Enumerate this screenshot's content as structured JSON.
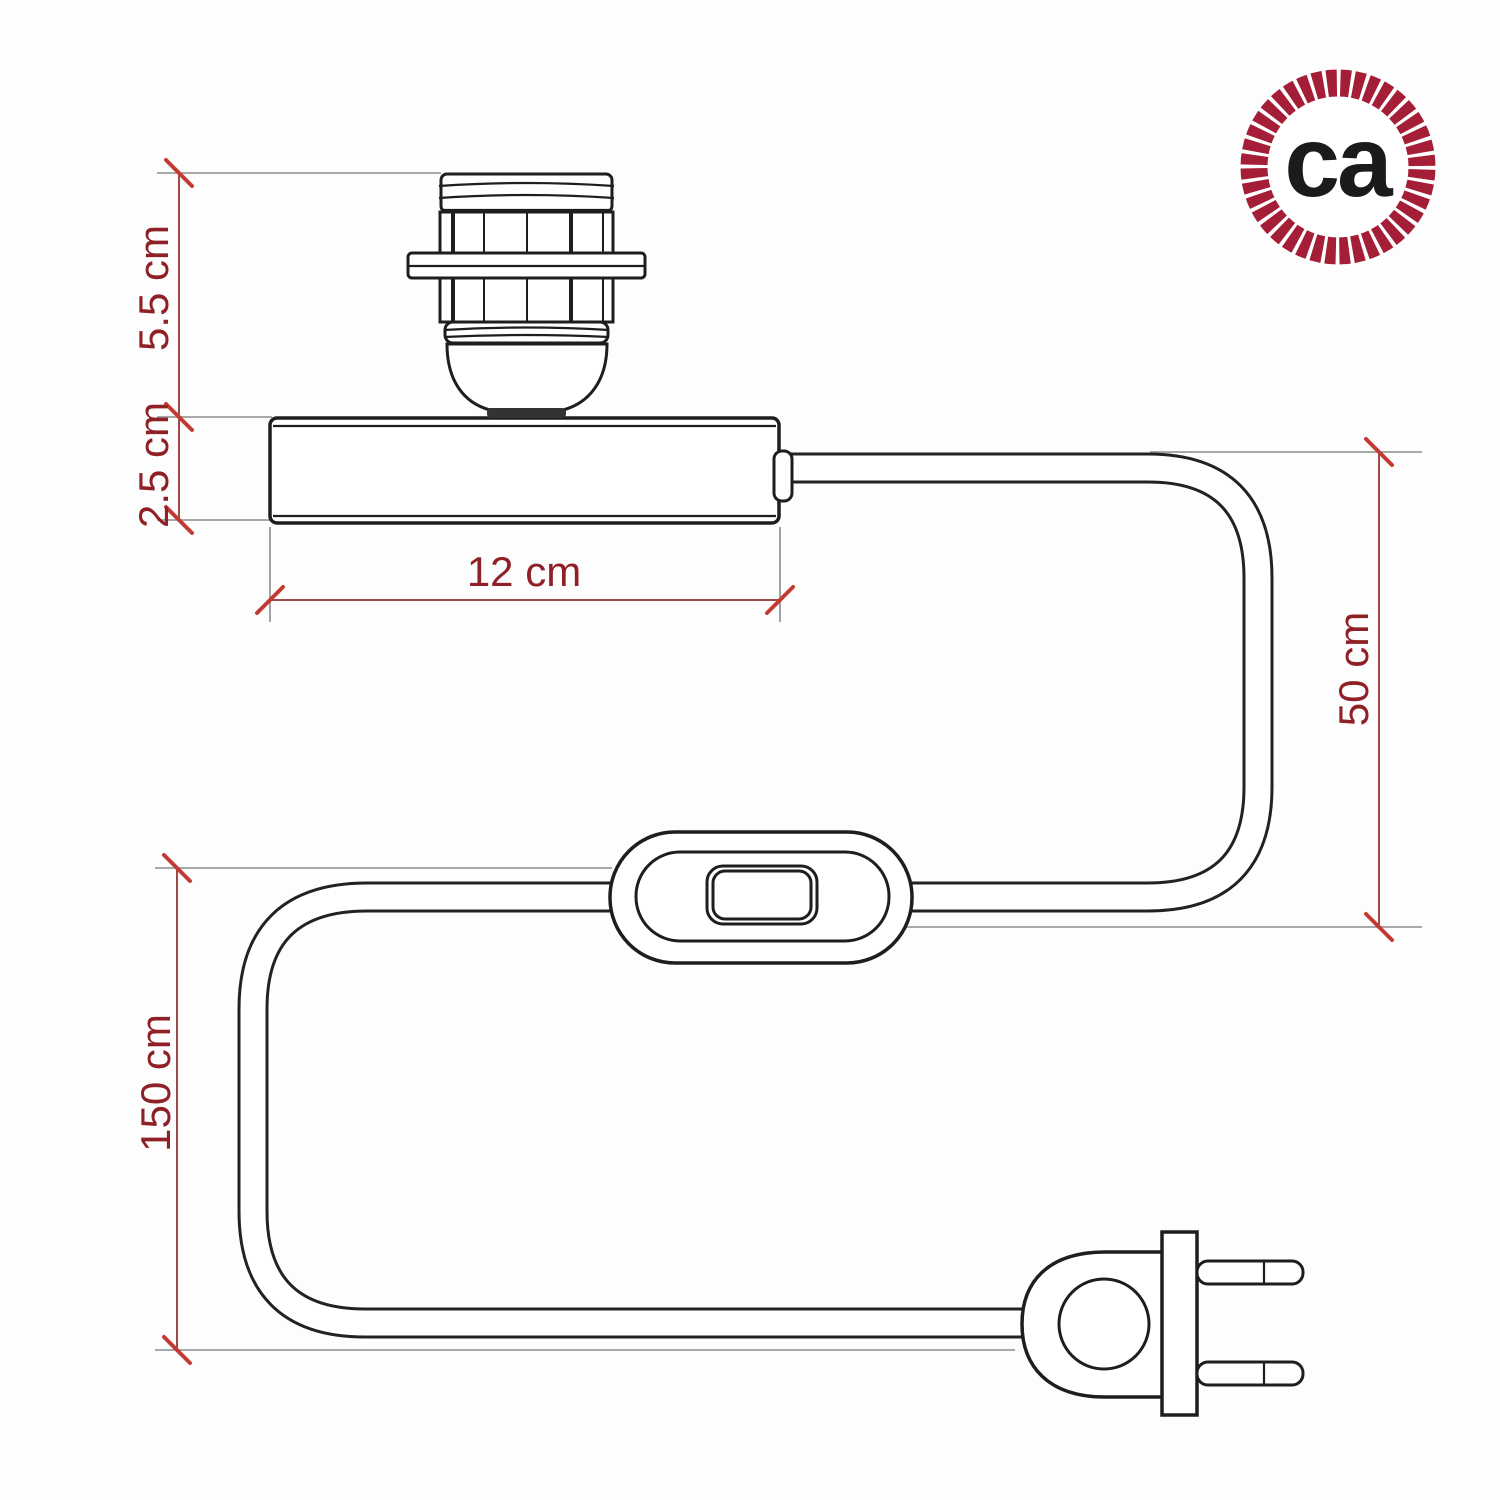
{
  "title": "Table lamp base technical drawing with dimensions",
  "logo": {
    "text": "ca"
  },
  "dimensions": {
    "socket_height": "5.5 cm",
    "base_height": "2.5 cm",
    "base_width": "12 cm",
    "base_to_switch_cable": "50 cm",
    "switch_to_plug_cable": "150 cm"
  },
  "colors": {
    "dimension_text": "#8e2026",
    "dimension_line": "#a04a46",
    "tick_mark": "#c23b32",
    "extension_line": "#8b8b8b",
    "drawing_line": "#1e1e1e",
    "logo_ring": "#a31e36",
    "logo_text": "#1b1b1b"
  }
}
